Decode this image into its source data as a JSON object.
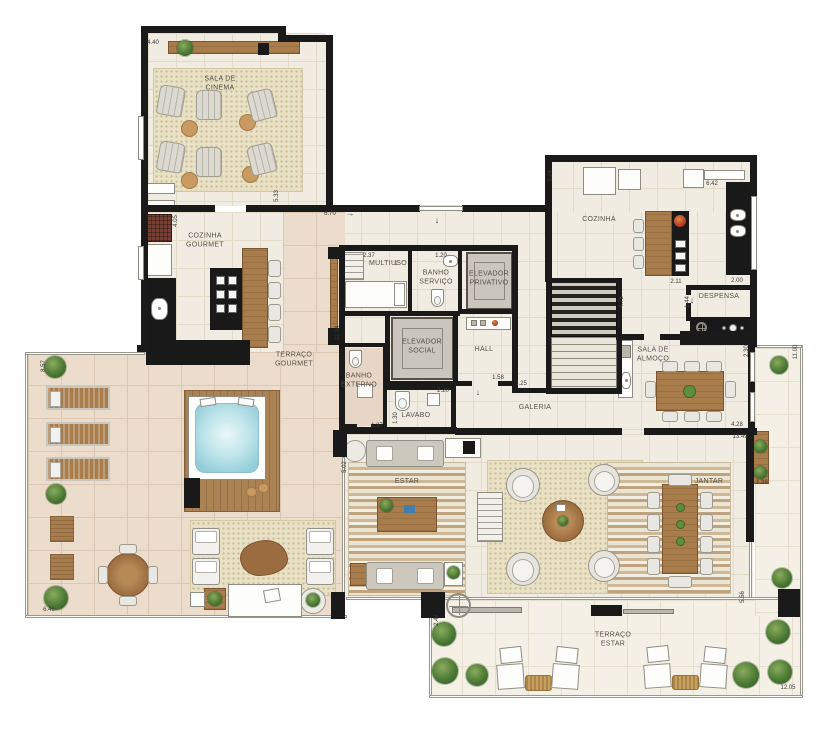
{
  "meta": {
    "type": "residential penthouse floor plan"
  },
  "palette": {
    "wall": "#1a1a1a",
    "floor_interior": "#f1ece1",
    "floor_terrace": "#ecdccc",
    "floor_outdoor": "#f4f0e5",
    "wood": "#a97c4b",
    "water": "#bfe5ea",
    "plant": "#4c7a35",
    "rug": "#e9e1c5"
  },
  "icons": {
    "entry_arrow": "↓",
    "dim_arrow_right": "→"
  },
  "floor_plan": {
    "rooms": [
      {
        "id": "sala-de-cinema",
        "label": "SALA DE\nCINEMA",
        "x": 220,
        "y": 84
      },
      {
        "id": "cozinha-gourmet",
        "label": "COZINHA\nGOURMET",
        "x": 205,
        "y": 241
      },
      {
        "id": "terraco-gourmet",
        "label": "TERRAÇO\nGOURMET",
        "x": 294,
        "y": 360
      },
      {
        "id": "multiuso",
        "label": "MULTIUSO",
        "x": 388,
        "y": 264
      },
      {
        "id": "banho-servico",
        "label": "BANHO\nSERVIÇO",
        "x": 436,
        "y": 278
      },
      {
        "id": "elevador-privativo",
        "label": "ELEVADOR\nPRIVATIVO",
        "x": 489,
        "y": 279
      },
      {
        "id": "elevador-social",
        "label": "ELEVADOR\nSOCIAL",
        "x": 422,
        "y": 347
      },
      {
        "id": "hall",
        "label": "HALL",
        "x": 484,
        "y": 350
      },
      {
        "id": "banho-externo",
        "label": "BANHO\nEXTERNO",
        "x": 359,
        "y": 381
      },
      {
        "id": "lavabo",
        "label": "LAVABO",
        "x": 416,
        "y": 416
      },
      {
        "id": "galeria",
        "label": "GALERIA",
        "x": 535,
        "y": 408
      },
      {
        "id": "cozinha",
        "label": "COZINHA",
        "x": 599,
        "y": 220
      },
      {
        "id": "despensa",
        "label": "DESPENSA",
        "x": 719,
        "y": 297
      },
      {
        "id": "sala-de-almoco",
        "label": "SALA DE\nALMOÇO",
        "x": 653,
        "y": 355
      },
      {
        "id": "estar",
        "label": "ESTAR",
        "x": 407,
        "y": 482
      },
      {
        "id": "jantar",
        "label": "JANTAR",
        "x": 709,
        "y": 482
      },
      {
        "id": "terraco-estar",
        "label": "TERRAÇO\nESTAR",
        "x": 613,
        "y": 640
      }
    ],
    "dimensions": [
      {
        "v": "4.40",
        "x": 153,
        "y": 43,
        "o": "h"
      },
      {
        "v": "5.33",
        "x": 277,
        "y": 196,
        "o": "v"
      },
      {
        "v": "4.05",
        "x": 176,
        "y": 221,
        "o": "v"
      },
      {
        "v": "6.70",
        "x": 330,
        "y": 214,
        "o": "h"
      },
      {
        "v": "12.04",
        "x": 338,
        "y": 333,
        "o": "v"
      },
      {
        "v": "2.37",
        "x": 369,
        "y": 256,
        "o": "h"
      },
      {
        "v": "1.20",
        "x": 441,
        "y": 256,
        "o": "h"
      },
      {
        "v": "2.20",
        "x": 443,
        "y": 391,
        "o": "h"
      },
      {
        "v": "1.37",
        "x": 377,
        "y": 426,
        "o": "h"
      },
      {
        "v": "1.30",
        "x": 396,
        "y": 418,
        "o": "v"
      },
      {
        "v": "1.58",
        "x": 498,
        "y": 378,
        "o": "h"
      },
      {
        "v": "3.25",
        "x": 521,
        "y": 384,
        "o": "h"
      },
      {
        "v": "5.02",
        "x": 345,
        "y": 467,
        "o": "v"
      },
      {
        "v": "3.24",
        "x": 551,
        "y": 176,
        "o": "v"
      },
      {
        "v": "6.42",
        "x": 712,
        "y": 184,
        "o": "h"
      },
      {
        "v": "2.11",
        "x": 676,
        "y": 282,
        "o": "h"
      },
      {
        "v": "2.00",
        "x": 737,
        "y": 281,
        "o": "h"
      },
      {
        "v": "1.44",
        "x": 688,
        "y": 302,
        "o": "v"
      },
      {
        "v": "4.76",
        "x": 622,
        "y": 302,
        "o": "v"
      },
      {
        "v": "2.30",
        "x": 747,
        "y": 351,
        "o": "v"
      },
      {
        "v": "4.28",
        "x": 737,
        "y": 425,
        "o": "h"
      },
      {
        "v": "13.49",
        "x": 740,
        "y": 437,
        "o": "h"
      },
      {
        "v": "1.38",
        "x": 762,
        "y": 483,
        "o": "h"
      },
      {
        "v": "11.00",
        "x": 796,
        "y": 352,
        "o": "v"
      },
      {
        "v": "5.56",
        "x": 743,
        "y": 597,
        "o": "v"
      },
      {
        "v": "2.44",
        "x": 437,
        "y": 620,
        "o": "v"
      },
      {
        "v": "12.05",
        "x": 788,
        "y": 688,
        "o": "h"
      },
      {
        "v": "8.57",
        "x": 44,
        "y": 366,
        "o": "v"
      },
      {
        "v": "6.46",
        "x": 49,
        "y": 610,
        "o": "h"
      }
    ],
    "arrows": [
      {
        "g": "↓",
        "x": 437,
        "y": 220
      },
      {
        "g": "→",
        "x": 350,
        "y": 213
      },
      {
        "g": "↓",
        "x": 396,
        "y": 262
      },
      {
        "g": "↓",
        "x": 692,
        "y": 300
      },
      {
        "g": "↓",
        "x": 478,
        "y": 392
      }
    ]
  }
}
